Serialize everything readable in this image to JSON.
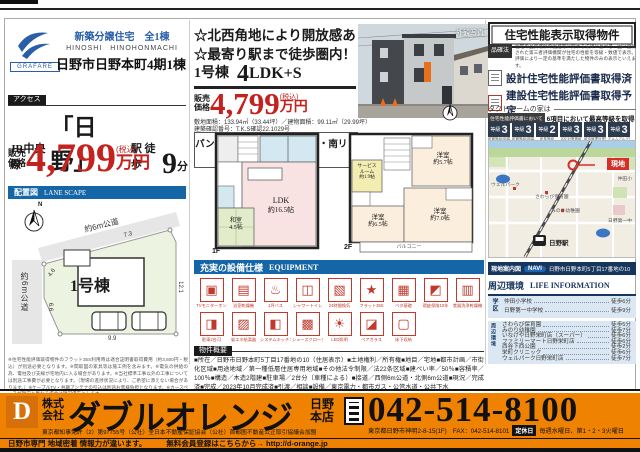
{
  "meta": {
    "accent_blue": "#1566a7",
    "price_red": "#c3221e",
    "brand_orange": "#ef8200",
    "navy": "#17365e",
    "map_red": "#d43028"
  },
  "header_left": {
    "brand": "GRAFARE",
    "catch": "新築分譲住宅　全1棟",
    "romaji": "HINOSHI　HINOHONMACHI",
    "title": "日野市日野本町4期1棟",
    "access_label": "アクセス",
    "line_name": "JR中央線",
    "station": "「日野」",
    "station_suffix": "駅 徒歩",
    "walk_min": "9",
    "walk_unit": "分",
    "price_label_1": "販売",
    "price_label_2": "価格",
    "price_value": "4,799",
    "price_tax": "(税込)",
    "price_unit": "万円"
  },
  "siteplan": {
    "section_label": "配置図",
    "section_en": "LANE SCAPE",
    "north": "N",
    "road_top": "約6m公道",
    "road_left": "約6m公道",
    "lot": "1号棟",
    "dim_top": "7.3",
    "dim_upper_left": "4.6",
    "dim_left": "6.6",
    "dim_bottom": "9.9",
    "dim_right": "12.1"
  },
  "center": {
    "catch1": "☆北西角地により開放感あり！",
    "catch2": "☆最寄り駅まで徒歩圏内！",
    "unit": "1号棟",
    "plan_big": "4",
    "plan_rest": "LDK+S",
    "price_label_1": "販売",
    "price_label_2": "価格",
    "price_value": "4,799",
    "price_tax": "(税込)",
    "price_unit": "万円",
    "area_line": "敷地面積：133.94㎡（33.44坪）／建物面積：99.11㎡（29.99坪）",
    "confirm_line": "建築確認番号：T.K.S確認22.1029号",
    "feature": "パントリー・サービスルーム・南リビング",
    "photo_label": "外観写真"
  },
  "floors": {
    "f1_label": "1F",
    "ldk_name": "LDK",
    "ldk_size": "約16.5帖",
    "washitsu_name": "和室",
    "washitsu_size": "4.5帖",
    "f2_label": "2F",
    "room_a_name": "洋室",
    "room_a_size": "約5.7帖",
    "service_l1": "サービス",
    "service_l2": "ルーム",
    "service_l3": "約1.9帖",
    "room_b_name": "洋室",
    "room_b_size": "約6.5帖",
    "room_c_name": "洋室",
    "room_c_size": "約7.0帖",
    "balcony": "バルコニー"
  },
  "equipment": {
    "title": "充実の設備仕様",
    "en": "EQUIPMENT",
    "row1": [
      {
        "icon": "▣",
        "label": "TVモニターホン"
      },
      {
        "icon": "▤",
        "label": "浴室乾燥機"
      },
      {
        "icon": "♨",
        "label": "1坪バス"
      },
      {
        "icon": "◫",
        "label": "シャワートイレ"
      },
      {
        "icon": "▧",
        "label": "24時間換気"
      },
      {
        "icon": "★",
        "label": "フラット35S"
      },
      {
        "icon": "▦",
        "label": "ベタ基礎"
      },
      {
        "icon": "◩",
        "label": "瑕疵保険10年"
      },
      {
        "icon": "▥",
        "label": "食器洗浄乾燥機"
      }
    ],
    "row2": [
      {
        "icon": "◨",
        "label": "駐車2台可"
      },
      {
        "icon": "▨",
        "label": "省エネ給湯器"
      },
      {
        "icon": "◧",
        "label": "システムキッチン"
      },
      {
        "icon": "▩",
        "label": "シューズクローク"
      },
      {
        "icon": "☀",
        "label": "LED照明"
      },
      {
        "icon": "◪",
        "label": "ペアガラス"
      },
      {
        "icon": "▢",
        "label": "床下収納"
      }
    ]
  },
  "outline": {
    "label": "物件概要",
    "text": "■所在／日野市日野本町5丁目17番地の10（住居表示）■土地権利／所有権■地目／宅地■都市計画／市街化区域■用途地域／第一種低層住居専用地域■その他法令制限／法22条区域■建ぺい率／50％■容積率／100％■構造／木造2階建■駐車場／2台分（車種による）■接道／西側6m公道・北側6m公道■現況／完成済■完成／2023年10月完成済■引渡／相談■設備／東京電力・都市ガス・公営水道・公共下水"
  },
  "performance": {
    "title": "住宅性能表示取得物件",
    "law": "品確法",
    "note": "住宅の品質確保の促進等に関する法律に基づき、国に登録された第三者評価機関が住宅の性能を等級・数値で表示。評価により一定の基準を満たした物件のみの表示といえます。",
    "eval1": "設計住宅性能評価書取得済",
    "eval2": "建設住宅性能評価書取得予定",
    "takt": "タクトホームの家は",
    "hl_badge": "住宅性能評価書において",
    "hl_text": "6項目において最高等級を取得",
    "grade_word": "等級",
    "grades": [
      {
        "value": "3",
        "label": "耐震等級(倒壊等防止)"
      },
      {
        "value": "3",
        "label": "耐震等級(損傷防止)"
      },
      {
        "value": "2",
        "label": "耐風等級"
      },
      {
        "value": "3",
        "label": "劣化対策等級"
      },
      {
        "value": "3",
        "label": "維持管理対策等級"
      },
      {
        "value": "3",
        "label": "ホルムアルデヒド対策"
      }
    ]
  },
  "map": {
    "genchi": "現地",
    "station": "日野駅",
    "landmarks": [
      {
        "label": "ウェルパーク"
      },
      {
        "label": "さわらび保育園"
      },
      {
        "label": "みのり幼稚園"
      },
      {
        "label": "仲田小"
      },
      {
        "label": "日野第一中"
      }
    ],
    "navi_label": "現地案内図",
    "navi_badge": "NAVI",
    "navi_address": "日野市日野本町5丁目17番地の10"
  },
  "life": {
    "header": "周辺環境",
    "en": "LIFE INFORMATION",
    "school_label": "学区",
    "schools": [
      {
        "name": "仲田小学校",
        "walk": "徒歩6分"
      },
      {
        "name": "日野第一中学校",
        "walk": "徒歩9分"
      }
    ],
    "env_label": "周辺環境",
    "items": [
      {
        "name": "さわらび保育園",
        "walk": "徒歩5分"
      },
      {
        "name": "みのり幼稚園",
        "walk": "徒歩7分"
      },
      {
        "name": "いなげや日野栄町店（スーパー）",
        "walk": "徒歩6分"
      },
      {
        "name": "ファミリーマート日野栄町店",
        "walk": "徒歩6分"
      },
      {
        "name": "西谷下西公園",
        "walk": "徒歩2分"
      },
      {
        "name": "栄町クリニック",
        "walk": "徒歩6分"
      },
      {
        "name": "ウェルパーク日野栄町店",
        "walk": "徒歩7分"
      }
    ]
  },
  "fine_print": "※住宅性能評価取得物件のフラット35S利用時は適合証明書取得費用（約3,500円・税込）が別途必要となります。※間取図の家具等は施工例を含みます。※電気の供給の為、電柱及び支線が宅地内に入る場合があります。※当社標準工事以外の工事については別途工事費が必要となります。（現場の進捗状況により、ご希望に添えない場合があります。）※ケーブルTV・共聴アンテナの引込は別途お客様負担となります。※カースペースが現況と異なる場合は現況優先とします。",
  "footer": {
    "logo_letter": "D",
    "co_prefix_1": "株式",
    "co_prefix_2": "会社",
    "name": "ダブルオレンジ",
    "branch_1": "日野",
    "branch_2": "本店",
    "phone": "042-514-8100",
    "license": "東京都知事免許（2）第97755号（公社）全日本不動産保証協会（公社）首都圏不動産公正取引協議会加盟",
    "address": "東京都日野市神明2-8-15(1F)　FAX：042-514-8101",
    "holiday_label": "定休日",
    "holiday": "毎週水曜日、第1・2・3火曜日",
    "tagline_left": "日野市専門 地域密着 情報力が違います。",
    "tagline_right": "無料会員登録はこちらから→ http://d-orange.jp"
  }
}
